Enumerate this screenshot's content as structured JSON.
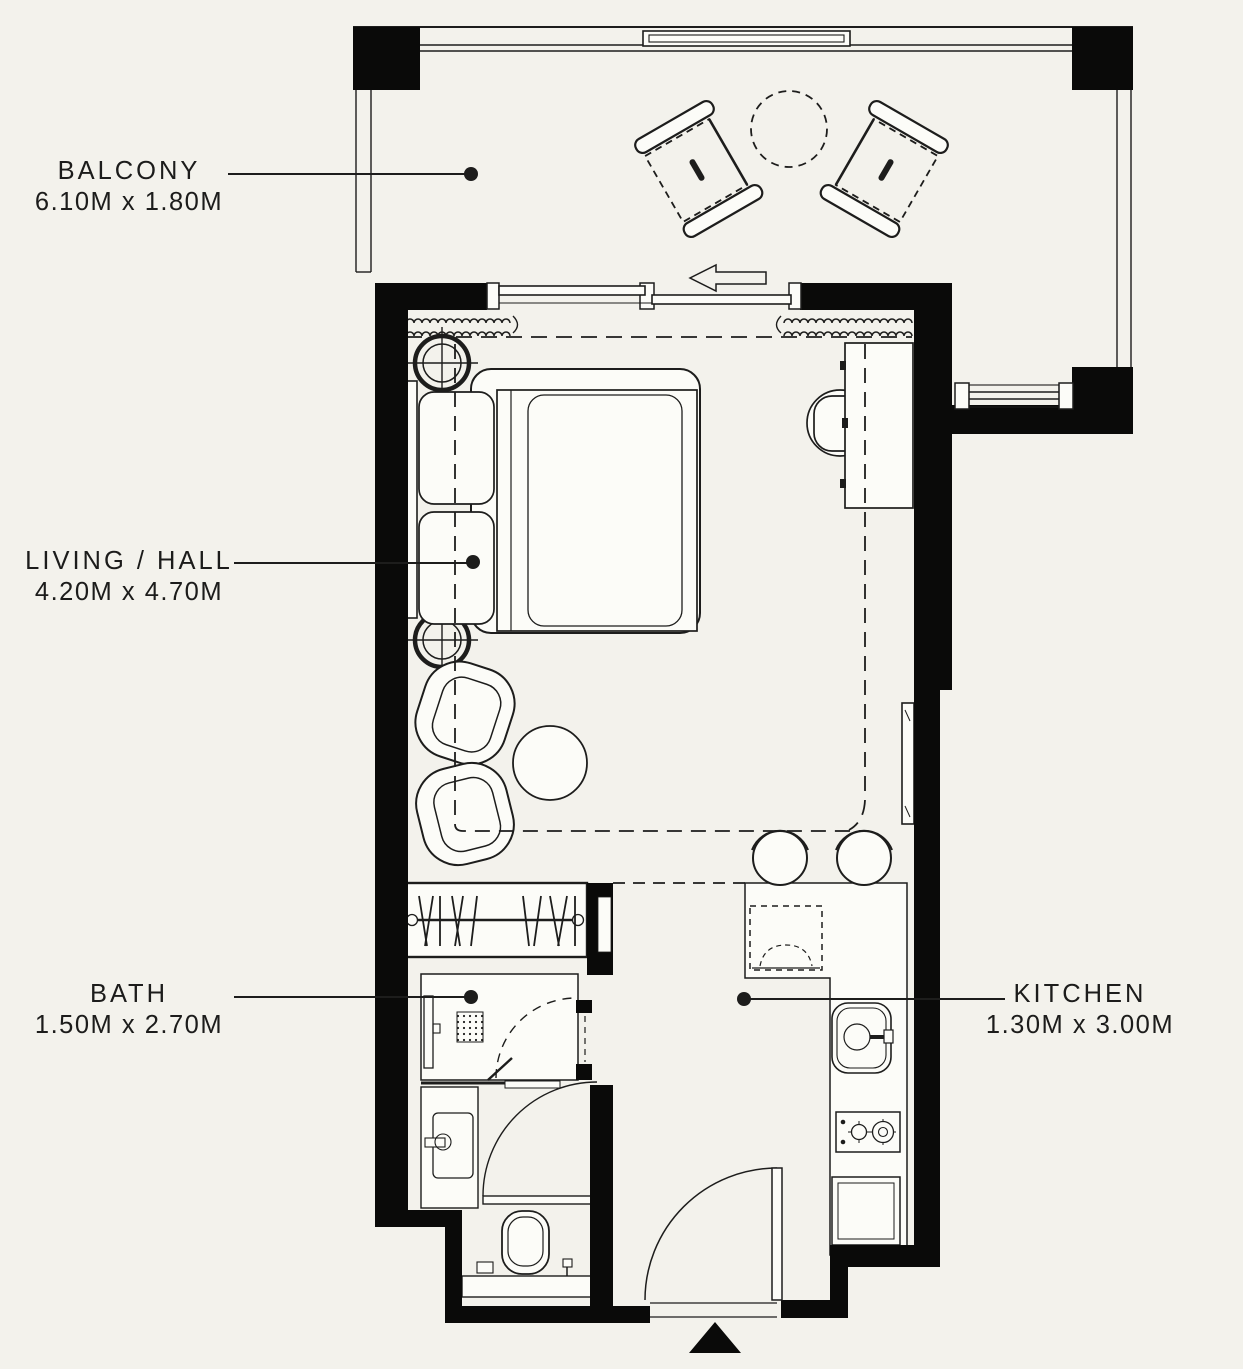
{
  "colors": {
    "background": "#f3f2ec",
    "line": "#1d1d1c",
    "wall": "#0a0a09",
    "furniture_fill": "#fcfcf8"
  },
  "rooms": {
    "balcony": {
      "name": "BALCONY",
      "dimensions": "6.10M x 1.80M"
    },
    "living": {
      "name": "LIVING / HALL",
      "dimensions": "4.20M x 4.70M"
    },
    "bath": {
      "name": "BATH",
      "dimensions": "1.50M x 2.70M"
    },
    "kitchen": {
      "name": "KITCHEN",
      "dimensions": "1.30M x 3.00M"
    }
  },
  "icons": {
    "furniture": [
      "balcony-chair",
      "balcony-round-table",
      "sliding-door",
      "curtain",
      "ceiling-light",
      "double-bed",
      "pillow",
      "desk",
      "desk-chair",
      "armchair",
      "side-table",
      "wall-mirror",
      "bar-stool",
      "wardrobe-rail",
      "shower",
      "floor-drain",
      "vanity-sink",
      "toilet",
      "refrigerator",
      "kitchen-sink",
      "gas-hob",
      "appliance",
      "entry-door",
      "entry-arrow"
    ]
  }
}
